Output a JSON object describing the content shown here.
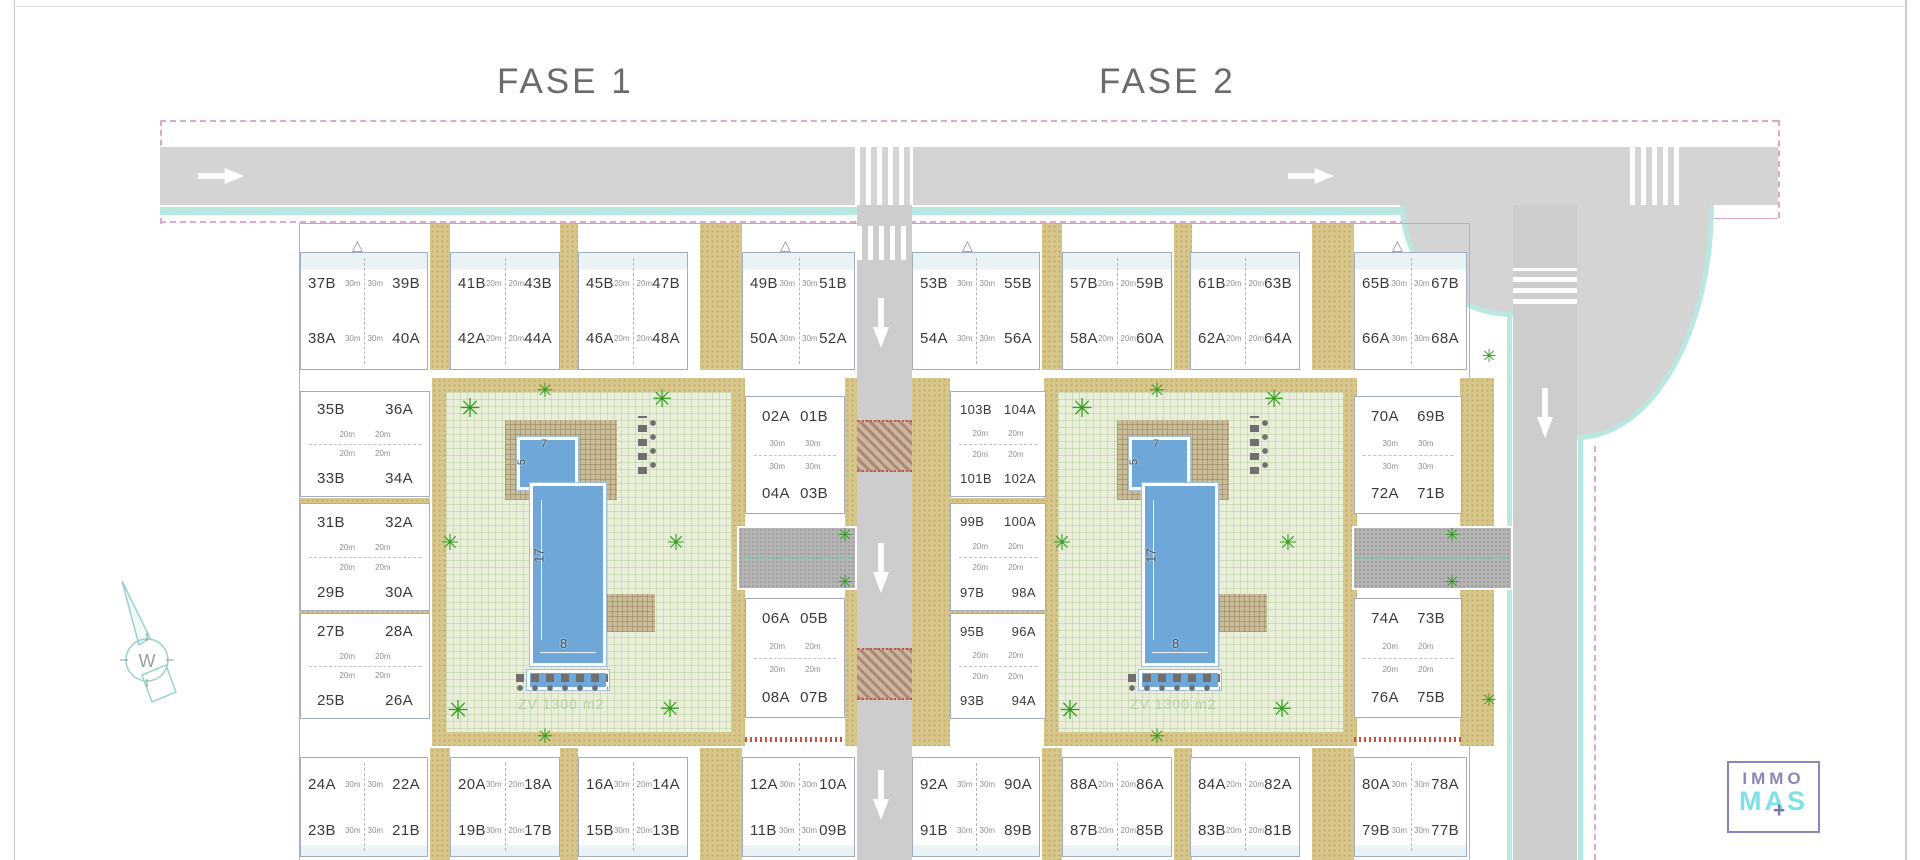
{
  "titles": {
    "phase1": "FASE 1",
    "phase2": "FASE 2"
  },
  "compass": {
    "letter": "W"
  },
  "pool": {
    "kids_width": "7",
    "kids_depth": "5",
    "length": "17",
    "width": "8",
    "green_zone": "ZV 1300 m2"
  },
  "logo": {
    "line1": "IMMO",
    "line2": "MAS",
    "plus": "+"
  },
  "colors": {
    "road": "#d4d4d4",
    "path_khaki": "#d8c78c",
    "lawn": "#e9efdb",
    "pool": "#6fa7d9",
    "boundary_pink": "#dba8d4",
    "sidewalk_teal": "#b9e7e1",
    "palm_green": "#2f9e1c",
    "logo_purple": "#8c85ba",
    "logo_cyan": "#7ee1ea",
    "marking_red": "#c9503c"
  },
  "phase1": {
    "top_row": [
      {
        "a": "37B",
        "b": "39B",
        "c": "38A",
        "d": "40A",
        "m1": "30m",
        "m2": "30m",
        "m3": "30m",
        "m4": "30m"
      },
      {
        "a": "41B",
        "b": "43B",
        "c": "42A",
        "d": "44A",
        "m1": "20m",
        "m2": "20m",
        "m3": "20m",
        "m4": "20m"
      },
      {
        "a": "45B",
        "b": "47B",
        "c": "46A",
        "d": "48A",
        "m1": "20m",
        "m2": "20m",
        "m3": "20m",
        "m4": "20m"
      },
      {
        "a": "49B",
        "b": "51B",
        "c": "50A",
        "d": "52A",
        "m1": "30m",
        "m2": "30m",
        "m3": "30m",
        "m4": "30m"
      }
    ],
    "left_col": [
      {
        "a": "35B",
        "b": "36A",
        "c": "33B",
        "d": "34A",
        "m1": "20m",
        "m2": "20m",
        "m3": "20m",
        "m4": "20m"
      },
      {
        "a": "31B",
        "b": "32A",
        "c": "29B",
        "d": "30A",
        "m1": "20m",
        "m2": "20m",
        "m3": "20m",
        "m4": "20m"
      },
      {
        "a": "27B",
        "b": "28A",
        "c": "25B",
        "d": "26A",
        "m1": "20m",
        "m2": "20m",
        "m3": "20m",
        "m4": "20m"
      }
    ],
    "mid_col": [
      {
        "a": "02A",
        "b": "01B",
        "c": "04A",
        "d": "03B",
        "m1": "30m",
        "m2": "30m",
        "m3": "30m",
        "m4": "30m"
      },
      {
        "a": "06A",
        "b": "05B",
        "c": "08A",
        "d": "07B",
        "m1": "20m",
        "m2": "20m",
        "m3": "20m",
        "m4": "20m"
      }
    ],
    "bottom_row": [
      {
        "a": "24A",
        "b": "22A",
        "c": "23B",
        "d": "21B",
        "m1": "30m",
        "m2": "30m",
        "m3": "30m",
        "m4": "30m"
      },
      {
        "a": "20A",
        "b": "18A",
        "c": "19B",
        "d": "17B",
        "m1": "30m",
        "m2": "20m",
        "m3": "30m",
        "m4": "20m"
      },
      {
        "a": "16A",
        "b": "14A",
        "c": "15B",
        "d": "13B",
        "m1": "30m",
        "m2": "20m",
        "m3": "30m",
        "m4": "20m"
      },
      {
        "a": "12A",
        "b": "10A",
        "c": "11B",
        "d": "09B",
        "m1": "30m",
        "m2": "30m",
        "m3": "30m",
        "m4": "30m"
      }
    ]
  },
  "phase2": {
    "top_row": [
      {
        "a": "53B",
        "b": "55B",
        "c": "54A",
        "d": "56A",
        "m1": "30m",
        "m2": "30m",
        "m3": "30m",
        "m4": "30m"
      },
      {
        "a": "57B",
        "b": "59B",
        "c": "58A",
        "d": "60A",
        "m1": "20m",
        "m2": "20m",
        "m3": "20m",
        "m4": "20m"
      },
      {
        "a": "61B",
        "b": "63B",
        "c": "62A",
        "d": "64A",
        "m1": "20m",
        "m2": "20m",
        "m3": "20m",
        "m4": "20m"
      },
      {
        "a": "65B",
        "b": "67B",
        "c": "66A",
        "d": "68A",
        "m1": "30m",
        "m2": "30m",
        "m3": "30m",
        "m4": "30m"
      }
    ],
    "left_col": [
      {
        "a": "103B",
        "b": "104A",
        "c": "101B",
        "d": "102A",
        "m1": "20m",
        "m2": "20m",
        "m3": "20m",
        "m4": "20m"
      },
      {
        "a": "99B",
        "b": "100A",
        "c": "97B",
        "d": "98A",
        "m1": "20m",
        "m2": "20m",
        "m3": "20m",
        "m4": "20m"
      },
      {
        "a": "95B",
        "b": "96A",
        "c": "93B",
        "d": "94A",
        "m1": "20m",
        "m2": "20m",
        "m3": "20m",
        "m4": "20m"
      }
    ],
    "right_col": [
      {
        "a": "70A",
        "b": "69B",
        "c": "72A",
        "d": "71B",
        "m1": "30m",
        "m2": "30m",
        "m3": "30m",
        "m4": "30m"
      },
      {
        "a": "74A",
        "b": "73B",
        "c": "76A",
        "d": "75B",
        "m1": "20m",
        "m2": "20m",
        "m3": "20m",
        "m4": "20m"
      }
    ],
    "bottom_row": [
      {
        "a": "92A",
        "b": "90A",
        "c": "91B",
        "d": "89B",
        "m1": "30m",
        "m2": "30m",
        "m3": "30m",
        "m4": "30m"
      },
      {
        "a": "88A",
        "b": "86A",
        "c": "87B",
        "d": "85B",
        "m1": "20m",
        "m2": "20m",
        "m3": "20m",
        "m4": "20m"
      },
      {
        "a": "84A",
        "b": "82A",
        "c": "83B",
        "d": "81B",
        "m1": "20m",
        "m2": "20m",
        "m3": "20m",
        "m4": "20m"
      },
      {
        "a": "80A",
        "b": "78A",
        "c": "79B",
        "d": "77B",
        "m1": "30m",
        "m2": "30m",
        "m3": "30m",
        "m4": "30m"
      }
    ]
  }
}
